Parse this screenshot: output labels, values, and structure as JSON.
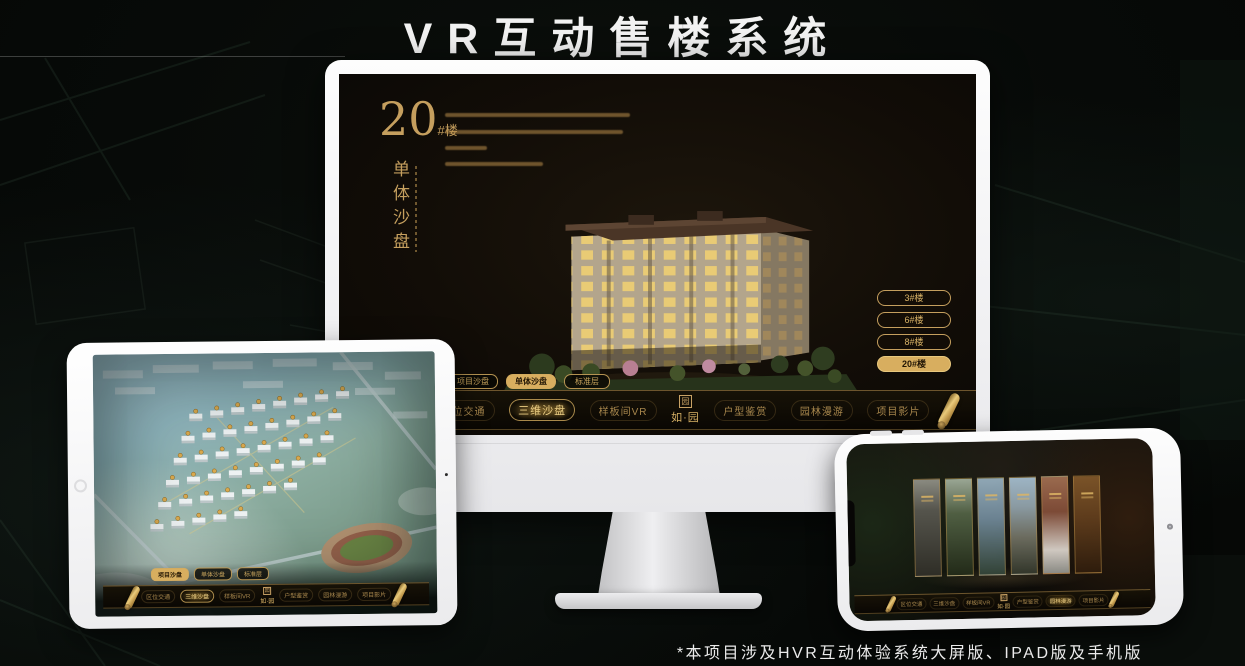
{
  "page": {
    "title": "VR互动售楼系统",
    "footnote": "*本项目涉及HVR互动体验系统大屏版、IPAD版及手机版"
  },
  "colors": {
    "gold": "#c9a265",
    "gold_bright": "#e8cb82",
    "gold_fill": "#d8ae5f",
    "screen_background": "#120d07",
    "title_text": "#f2f2f2"
  },
  "nav": {
    "logo_mark": "园",
    "logo_text": "如·园",
    "items": [
      "区位交通",
      "三维沙盘",
      "样板间VR",
      "户型鉴赏",
      "园林漫游",
      "项目影片"
    ]
  },
  "tabs": [
    "项目沙盘",
    "单体沙盘",
    "标准层"
  ],
  "monitor": {
    "hero_number": "20",
    "hero_suffix": "#楼",
    "hero_title": "单体沙盘",
    "floor_buttons": [
      {
        "label": "3#楼",
        "active": false
      },
      {
        "label": "6#楼",
        "active": false
      },
      {
        "label": "8#楼",
        "active": false
      },
      {
        "label": "20#楼",
        "active": true
      }
    ],
    "active_tab": "单体沙盘",
    "active_nav_item": "三维沙盘"
  },
  "tablet": {
    "active_tab": "项目沙盘",
    "active_nav_item": "三维沙盘"
  },
  "phone": {
    "active_nav_item": "园林漫游",
    "gallery_panel_count": 6
  }
}
